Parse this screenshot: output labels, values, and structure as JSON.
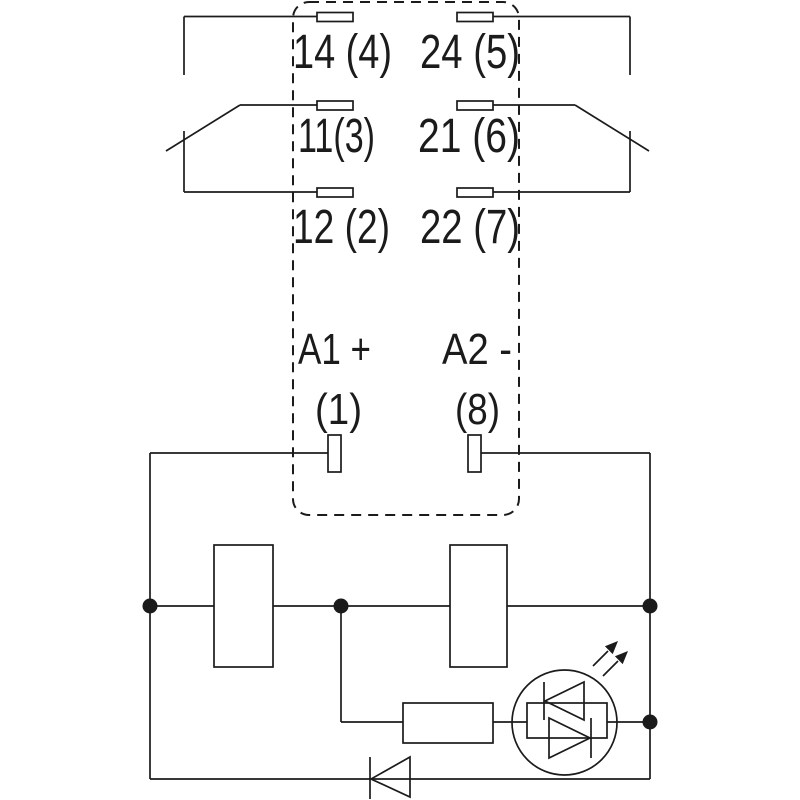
{
  "diagram": {
    "type": "relay-wiring-schematic",
    "colors": {
      "line": "#1b1b1b",
      "background": "#ffffff"
    },
    "labels": {
      "contact_no_left": "14 (4)",
      "contact_no_right": "24 (5)",
      "contact_com_left": "11(3)",
      "contact_com_right": "21 (6)",
      "contact_nc_left": "12 (2)",
      "contact_nc_right": "22 (7)",
      "coil_plus": "A1 +",
      "coil_minus": "A2 -",
      "coil_pin_left": "(1)",
      "coil_pin_right": "(8)"
    },
    "components": [
      "relay-outline-dashed",
      "changeover-contact-left",
      "changeover-contact-right",
      "coil-terminal-a1",
      "coil-terminal-a2",
      "coil-box-left",
      "coil-box-right",
      "series-resistor",
      "bidirectional-led-indicator",
      "freewheeling-diode"
    ]
  }
}
